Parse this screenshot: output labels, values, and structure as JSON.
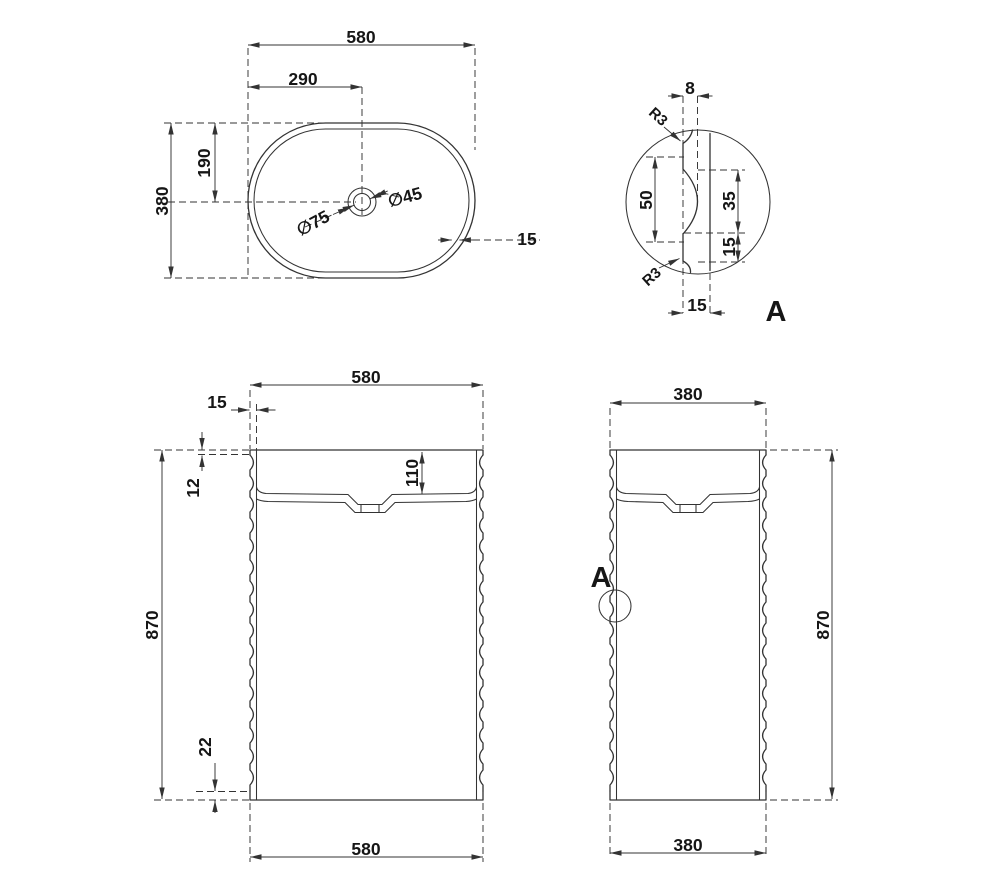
{
  "top_view": {
    "width": "580",
    "hole_offset_x": "290",
    "hole_offset_y": "190",
    "depth": "380",
    "rim_wall": "15",
    "drain_outer_dia": "∅75",
    "drain_inner_dia": "∅45"
  },
  "detail_a": {
    "title": "A",
    "groove_depth": "8",
    "fillet_top": "R3",
    "fillet_bottom": "R3",
    "groove_pitch": "50",
    "groove_height": "35",
    "flat_height": "15",
    "wall_thickness": "15"
  },
  "front_view": {
    "width_top": "580",
    "width_bottom": "580",
    "wall": "15",
    "rim_height": "12",
    "basin_depth": "110",
    "height": "870",
    "base_clearance": "22"
  },
  "side_view": {
    "depth_top": "380",
    "depth_bottom": "380",
    "height": "870",
    "detail_marker": "A"
  },
  "colors": {
    "line": "#333333",
    "background": "#ffffff"
  }
}
